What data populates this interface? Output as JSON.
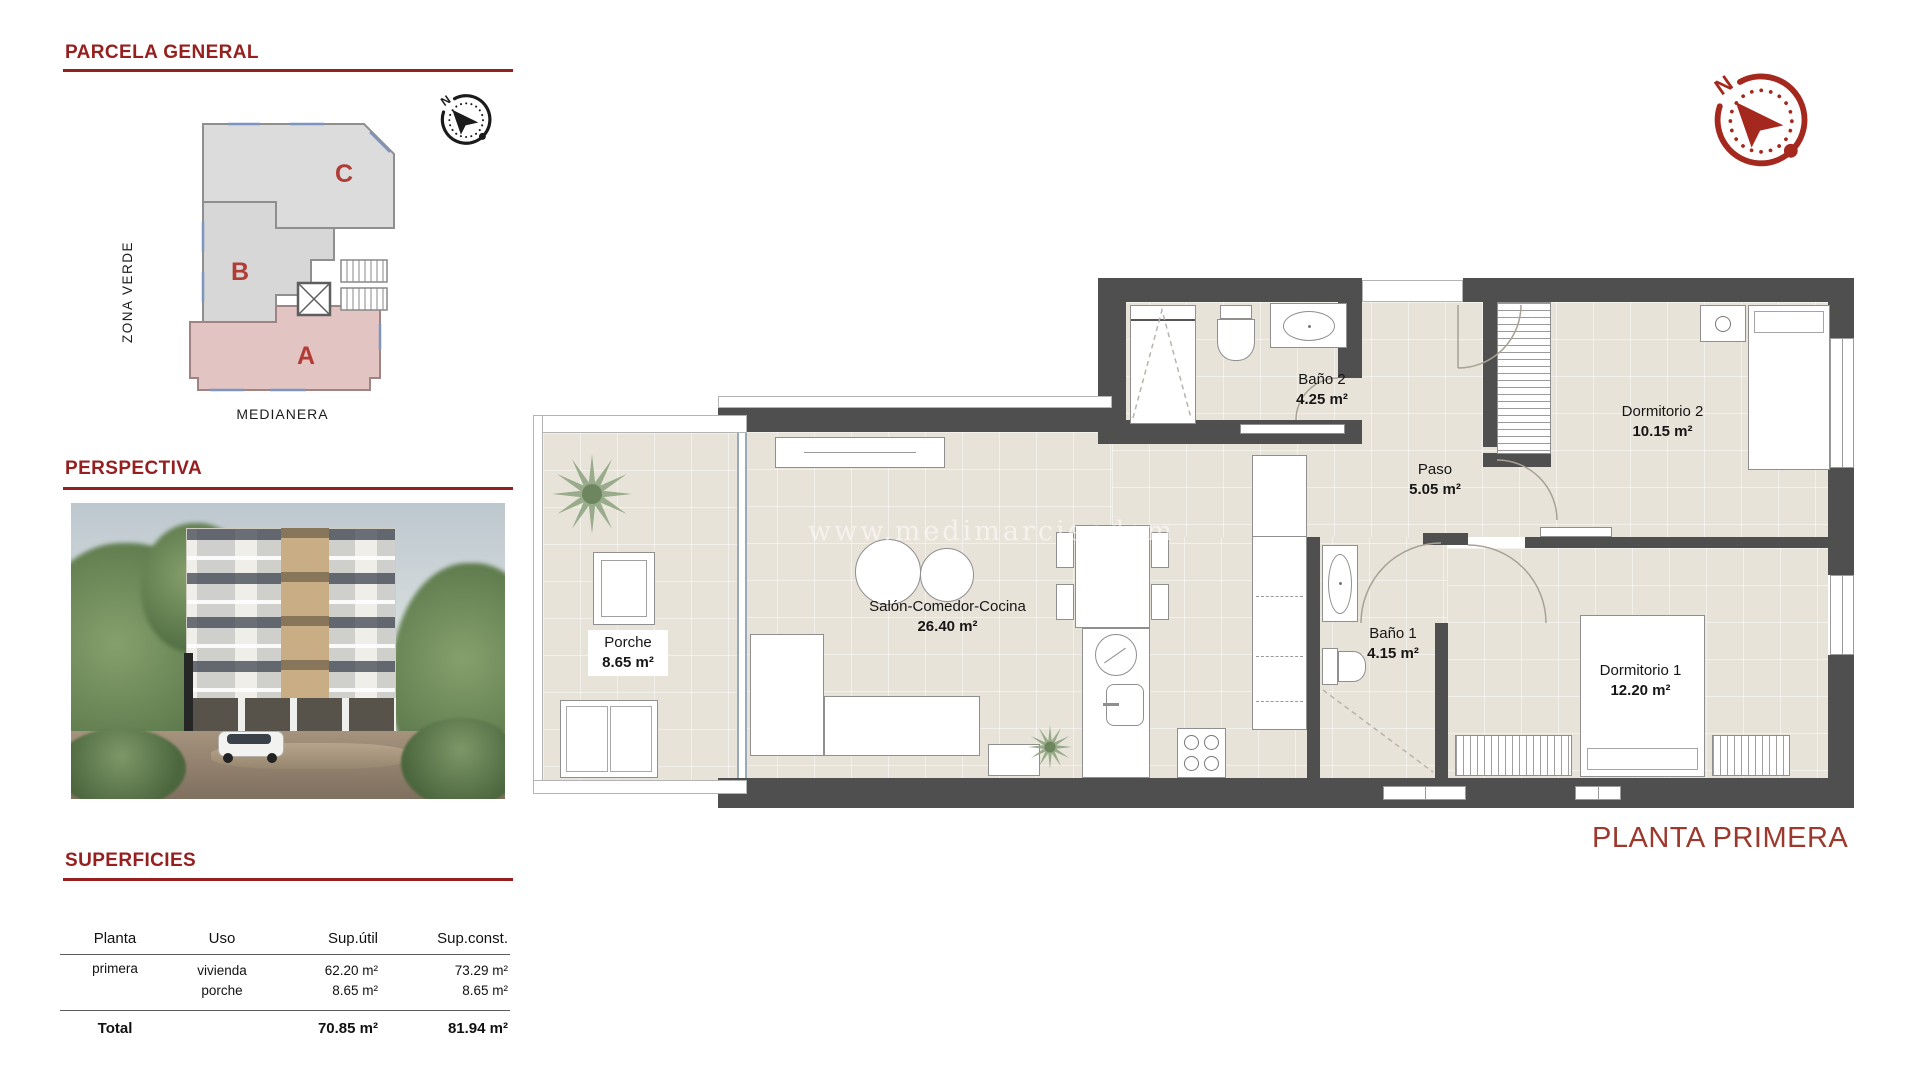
{
  "accent_color": "#96201f",
  "compass_color": "#a5281f",
  "wall_color": "#4f4f4f",
  "floor_color": "#e8e3d8",
  "sidebar": {
    "parcela": {
      "title": "PARCELA GENERAL",
      "zona_verde": "ZONA VERDE",
      "medianera": "MEDIANERA",
      "blocks": {
        "a": "A",
        "b": "B",
        "c": "C"
      }
    },
    "perspectiva": {
      "title": "PERSPECTIVA"
    },
    "superficies": {
      "title": "SUPERFICIES",
      "headers": [
        "Planta",
        "Uso",
        "Sup.útil",
        "Sup.const."
      ],
      "rows": [
        {
          "planta": "primera",
          "uso": [
            "vivienda",
            "porche"
          ],
          "sup_util": [
            "62.20 m²",
            "8.65 m²"
          ],
          "sup_const": [
            "73.29 m²",
            "8.65 m²"
          ]
        }
      ],
      "total": {
        "label": "Total",
        "sup_util": "70.85 m²",
        "sup_const": "81.94 m²"
      }
    }
  },
  "plan": {
    "title": "PLANTA PRIMERA",
    "watermark": "www.medimarciendom",
    "compass_n": "N",
    "rooms": {
      "porche": {
        "name": "Porche",
        "area": "8.65 m²"
      },
      "salon": {
        "name": "Salón-Comedor-Cocina",
        "area": "26.40 m²"
      },
      "bano2": {
        "name": "Baño 2",
        "area": "4.25 m²"
      },
      "paso": {
        "name": "Paso",
        "area": "5.05 m²"
      },
      "dormitorio2": {
        "name": "Dormitorio 2",
        "area": "10.15 m²"
      },
      "bano1": {
        "name": "Baño 1",
        "area": "4.15 m²"
      },
      "dormitorio1": {
        "name": "Dormitorio 1",
        "area": "12.20 m²"
      }
    }
  }
}
